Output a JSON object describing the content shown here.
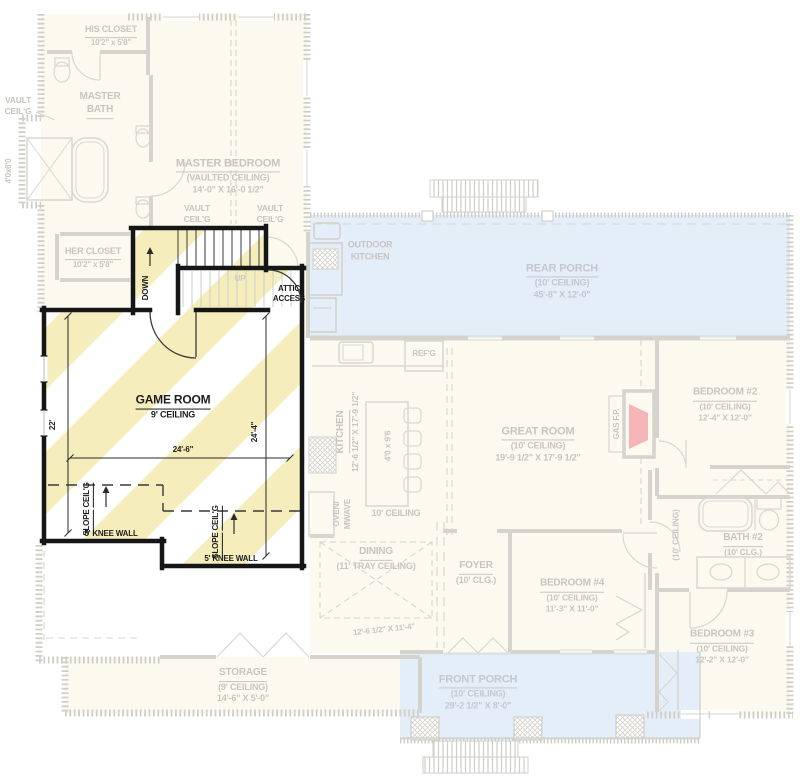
{
  "colors": {
    "stripe_yellow": "#f5edbb",
    "porch_blue": "#e4eef8",
    "cream_floor": "#fcfaef",
    "faded_line_gray": "#d4d3cc",
    "faded_text_gray": "#c6c5bf",
    "overlay_wall_black": "#161616",
    "fireplace_pink": "#f4b4b8"
  },
  "overlay": {
    "stairs": {
      "down": "DOWN",
      "up": "UP",
      "attic_line1": "ATTIC",
      "attic_line2": "ACCESS"
    },
    "game_room": {
      "name": "GAME ROOM",
      "ceiling": "9' CEILING",
      "dim_width": "24'-6\"",
      "dim_left": "22'",
      "dim_right": "24'-4\""
    },
    "slope": {
      "line1": "SLOPE",
      "line2": "CEIL'G",
      "knee_wall": "5' KNEE WALL"
    }
  },
  "ff": {
    "vault_label": {
      "line1": "VAULT",
      "line2": "CEIL'G"
    },
    "his_closet": {
      "name": "HIS CLOSET",
      "dims": "10'2\" x 5'8\""
    },
    "master_bath": {
      "line1": "MASTER",
      "line2": "BATH"
    },
    "shower_dims": "4'0x6'0",
    "master_bedroom": {
      "name": "MASTER BEDROOM",
      "ceiling": "(VAULTED CEILING)",
      "dims": "14'-0\" X 16'-0 1/2\""
    },
    "her_closet": {
      "name": "HER CLOSET",
      "dims": "10'2\" x 5'8\""
    },
    "outdoor_kitchen": {
      "line1": "OUTDOOR",
      "line2": "KITCHEN"
    },
    "rear_porch": {
      "name": "REAR PORCH",
      "ceiling": "(10' CEILING)",
      "dims": "45'-8\" X 12'-0\""
    },
    "refg": "REF'G",
    "kitchen": {
      "name": "KITCHEN",
      "dims": "12'-6 1/2\" X 17'-9 1/2\"",
      "island": "4'0 x 9'6",
      "oven_line1": "OVEN/",
      "oven_line2": "MWAVE",
      "ceiling": "10' CEILING"
    },
    "great_room": {
      "name": "GREAT ROOM",
      "ceiling": "(10' CEILING)",
      "dims": "19'-9 1/2\" X 17'-9 1/2\"",
      "fireplace": "GAS F.P."
    },
    "bedroom2": {
      "name": "BEDROOM #2",
      "ceiling": "(10' CEILING)",
      "dims": "12'-4\" X 12'-0\""
    },
    "hall_ceiling": "(10' CEILING)",
    "bath2": {
      "name": "BATH #2",
      "ceiling": "(10' CLG.)"
    },
    "bedroom3": {
      "name": "BEDROOM #3",
      "ceiling": "(10' CEILING)",
      "dims": "12'-2\" X 12'-0\""
    },
    "bedroom4": {
      "name": "BEDROOM #4",
      "ceiling": "(10' CEILING)",
      "dims": "11'-3\" X 11'-0\""
    },
    "foyer": {
      "name": "FOYER",
      "ceiling": "(10' CLG.)"
    },
    "dining": {
      "name": "DINING",
      "ceiling": "(11' TRAY CEILING)",
      "dims": "12'-6 1/2\" X 11'-4\""
    },
    "storage": {
      "name": "STORAGE",
      "ceiling": "(9' CEILING)",
      "dims": "14'-6\" X 5'-0\""
    },
    "front_porch": {
      "name": "FRONT PORCH",
      "ceiling": "(10' CEILING)",
      "dims": "29'-2 1/2\" X 8'-0\""
    }
  }
}
